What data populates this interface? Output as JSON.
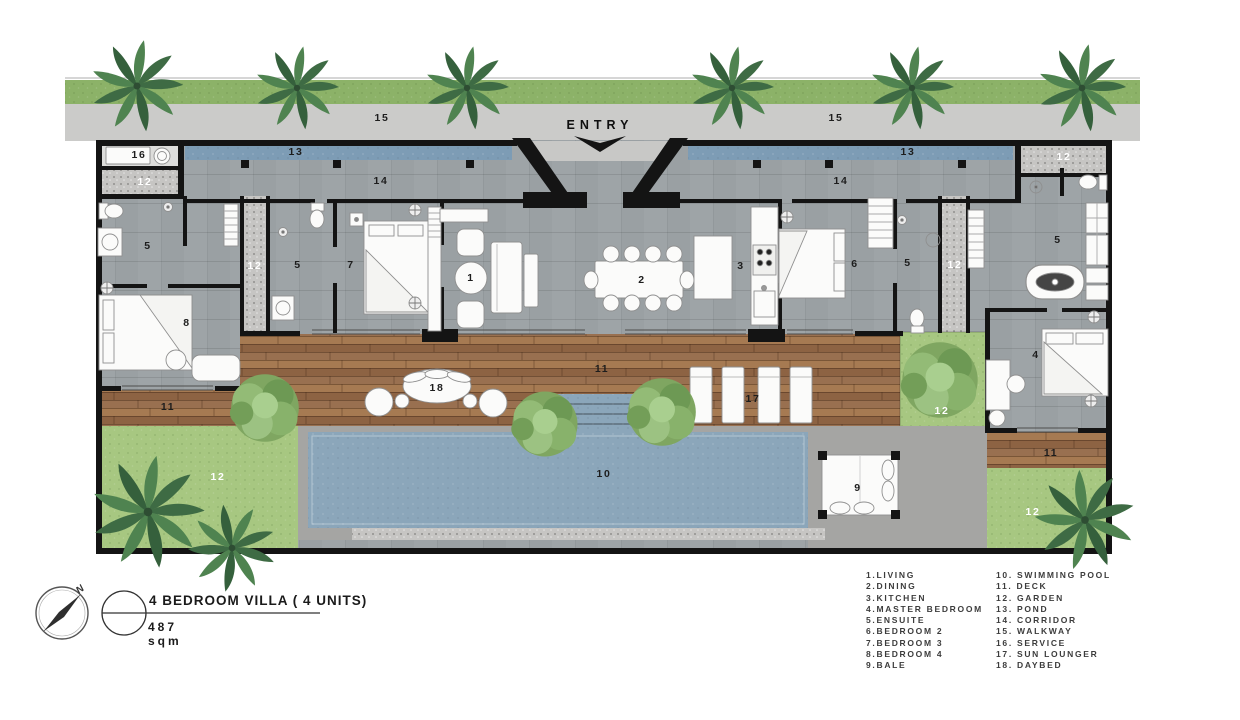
{
  "entry": {
    "label": "ENTRY"
  },
  "title_block": {
    "title": "4 BEDROOM VILLA ( 4 UNITS)",
    "area": "487 sqm",
    "compass_letter": "N"
  },
  "legend": {
    "column1": [
      "1.LIVING",
      "2.DINING",
      "3.KITCHEN",
      "4.MASTER BEDROOM",
      "5.ENSUITE",
      "6.BEDROOM 2",
      "7.BEDROOM 3",
      "8.BEDROOM 4",
      "9.BALE"
    ],
    "column2": [
      "10. SWIMMING POOL",
      "11. DECK",
      "12. GARDEN",
      "13. POND",
      "14. CORRIDOR",
      "15. WALKWAY",
      "16. SERVICE",
      "17. SUN LOUNGER",
      "18. DAYBED"
    ]
  },
  "plan_labels": [
    {
      "t": "15",
      "n": "walkway",
      "x": 382,
      "y": 118
    },
    {
      "t": "15",
      "n": "walkway",
      "x": 836,
      "y": 118
    },
    {
      "t": "16",
      "n": "service",
      "x": 139,
      "y": 155
    },
    {
      "t": "13",
      "n": "pond",
      "x": 296,
      "y": 152
    },
    {
      "t": "13",
      "n": "pond",
      "x": 908,
      "y": 152
    },
    {
      "t": "14",
      "n": "corridor",
      "x": 381,
      "y": 181
    },
    {
      "t": "14",
      "n": "corridor",
      "x": 841,
      "y": 181
    },
    {
      "t": "12",
      "n": "garden",
      "x": 145,
      "y": 182,
      "light": true
    },
    {
      "t": "12",
      "n": "garden",
      "x": 255,
      "y": 266,
      "light": true
    },
    {
      "t": "12",
      "n": "garden",
      "x": 955,
      "y": 265,
      "light": true
    },
    {
      "t": "12",
      "n": "garden",
      "x": 1064,
      "y": 157,
      "light": true
    },
    {
      "t": "12",
      "n": "garden",
      "x": 942,
      "y": 411,
      "light": true
    },
    {
      "t": "12",
      "n": "garden",
      "x": 218,
      "y": 477,
      "light": true
    },
    {
      "t": "12",
      "n": "garden",
      "x": 1033,
      "y": 512,
      "light": true
    },
    {
      "t": "5",
      "n": "ensuite",
      "x": 148,
      "y": 246
    },
    {
      "t": "5",
      "n": "ensuite",
      "x": 298,
      "y": 265
    },
    {
      "t": "5",
      "n": "ensuite",
      "x": 908,
      "y": 263
    },
    {
      "t": "5",
      "n": "ensuite",
      "x": 1058,
      "y": 240
    },
    {
      "t": "7",
      "n": "bedroom-3",
      "x": 351,
      "y": 265
    },
    {
      "t": "1",
      "n": "living",
      "x": 471,
      "y": 278
    },
    {
      "t": "2",
      "n": "dining",
      "x": 642,
      "y": 280
    },
    {
      "t": "3",
      "n": "kitchen",
      "x": 741,
      "y": 266
    },
    {
      "t": "6",
      "n": "bedroom-2",
      "x": 855,
      "y": 264
    },
    {
      "t": "8",
      "n": "bedroom-4",
      "x": 187,
      "y": 323
    },
    {
      "t": "4",
      "n": "master-bedroom",
      "x": 1036,
      "y": 355
    },
    {
      "t": "11",
      "n": "deck",
      "x": 168,
      "y": 407
    },
    {
      "t": "11",
      "n": "deck",
      "x": 602,
      "y": 369
    },
    {
      "t": "11",
      "n": "deck",
      "x": 1051,
      "y": 453
    },
    {
      "t": "18",
      "n": "daybed",
      "x": 437,
      "y": 388
    },
    {
      "t": "17",
      "n": "sun-lounger",
      "x": 753,
      "y": 399
    },
    {
      "t": "10",
      "n": "swimming-pool",
      "x": 604,
      "y": 474
    },
    {
      "t": "9",
      "n": "bale",
      "x": 858,
      "y": 488
    }
  ],
  "colors": {
    "wall": "#141414",
    "floor_tile": "#9aa0a3",
    "pond": "#7d9cb5",
    "pool": "#8ba6ba",
    "deck_wood": "#9c744f",
    "grass_top": "#8cb268",
    "garden_grass": "#a7c781",
    "walkway": "#cbcbc9",
    "gravel": "#c6c5c3",
    "paving": "#a5a5a3"
  }
}
